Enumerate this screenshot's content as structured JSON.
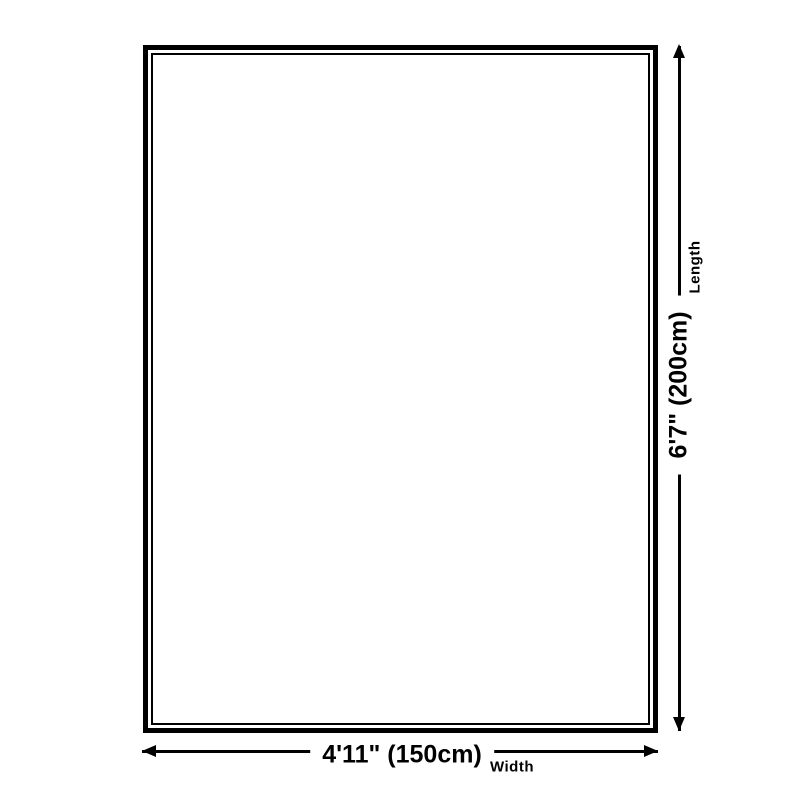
{
  "diagram": {
    "background_color": "#ffffff",
    "line_color": "#000000",
    "width_dimension": {
      "value": "4'11\" (150cm)",
      "label": "Width"
    },
    "length_dimension": {
      "value": "6'7\" (200cm)",
      "label": "Length"
    }
  }
}
